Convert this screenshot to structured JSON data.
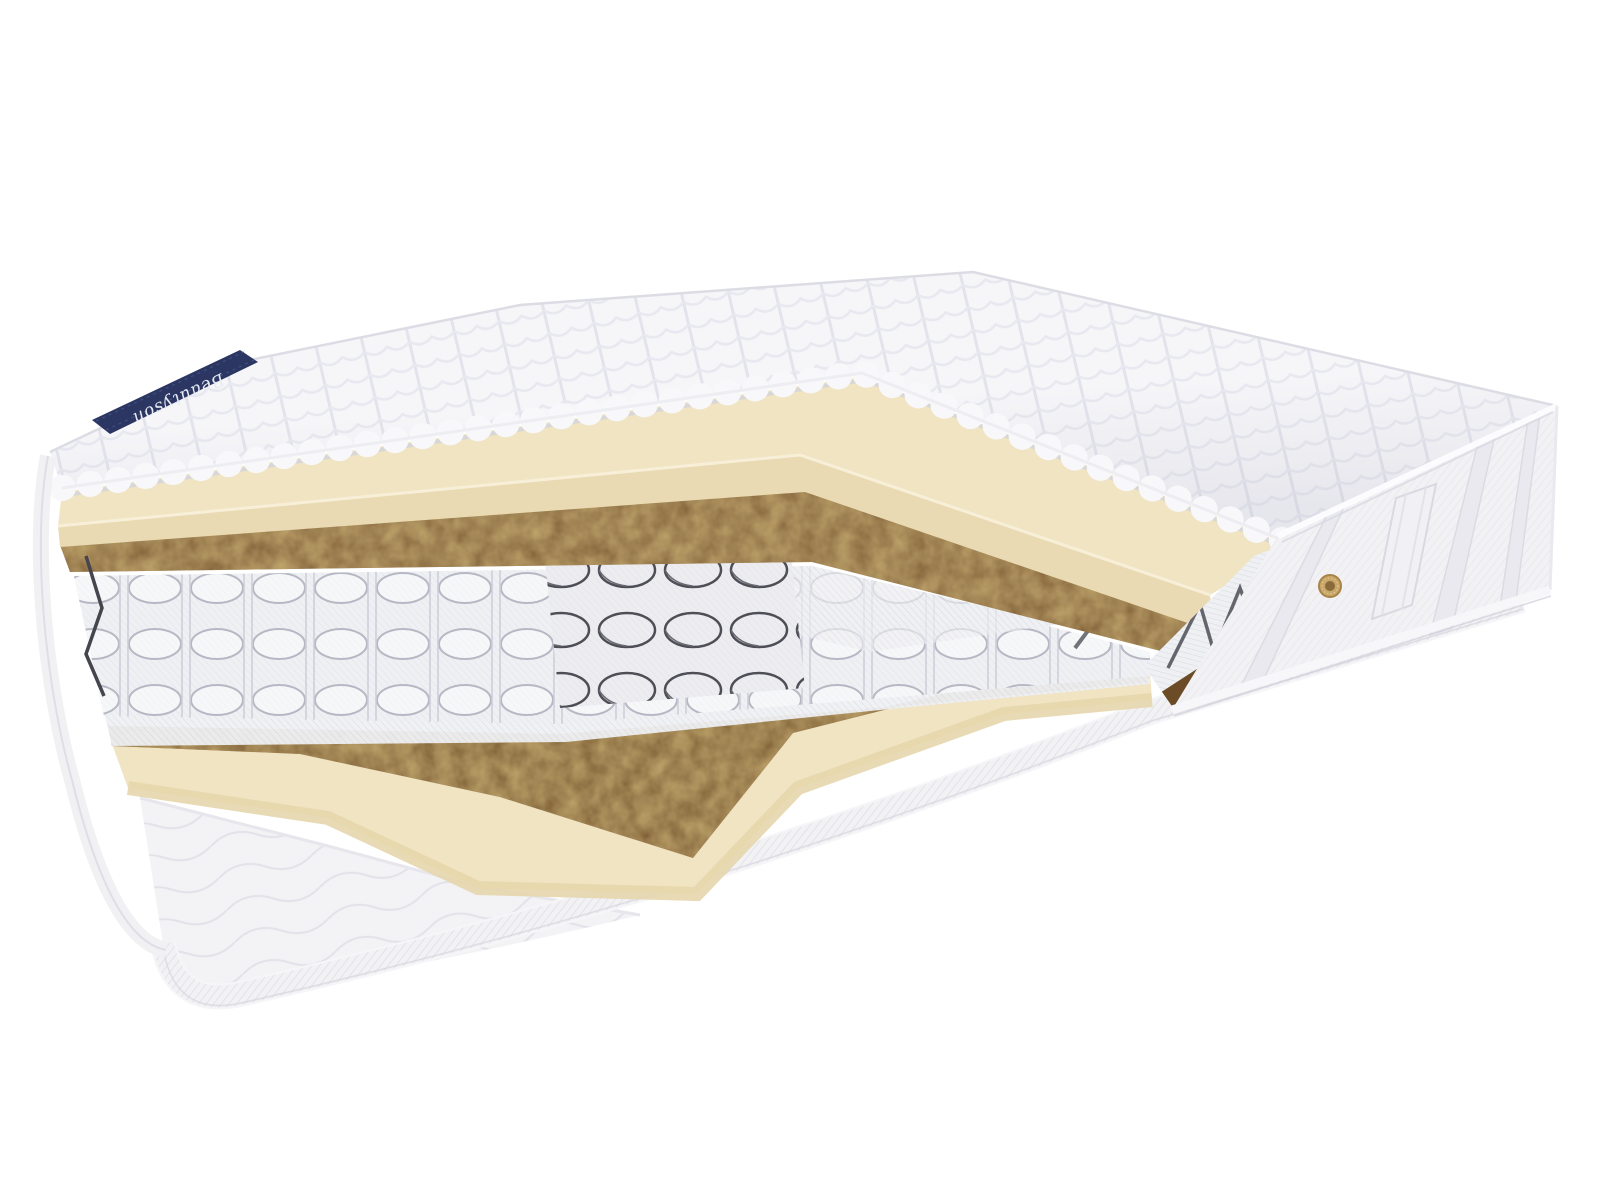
{
  "scene": {
    "type": "product-photo",
    "subject": "mattress cutaway showing internal layers",
    "background_color": "#ffffff",
    "brand_ribbon": {
      "text": "Beautyson",
      "fabric_color": "#2b3762",
      "text_color": "#e9ebf3"
    },
    "parts": {
      "top_cover": {
        "name": "quilted top cover",
        "color": "#f6f6f9"
      },
      "foam_top_layer": {
        "name": "foam comfort layer",
        "color": "#f0e4c3"
      },
      "coir_top_layer": {
        "name": "coconut coir layer",
        "color": "#7a5730"
      },
      "spring_block": {
        "name": "pocket spring block",
        "pocket_color": "#ededf1",
        "wire_color": "#4e4e57"
      },
      "bare_springs": {
        "name": "exposed steel coils",
        "color": "#4e4e57"
      },
      "coir_bottom_layer": {
        "name": "coconut coir base layer",
        "color": "#7a5730"
      },
      "foam_bottom_layer": {
        "name": "foam base layer",
        "color": "#f0e4c3"
      },
      "bottom_cover": {
        "name": "quilted bottom cover with piping",
        "color": "#f3f3f6"
      },
      "side_panel": {
        "name": "jacquard side border",
        "color": "#f2f2f6"
      },
      "handle": {
        "name": "side handle strap",
        "color": "#f1f1f5"
      },
      "air_vent": {
        "name": "brass air vent grommet",
        "color": "#c9a768"
      }
    }
  }
}
